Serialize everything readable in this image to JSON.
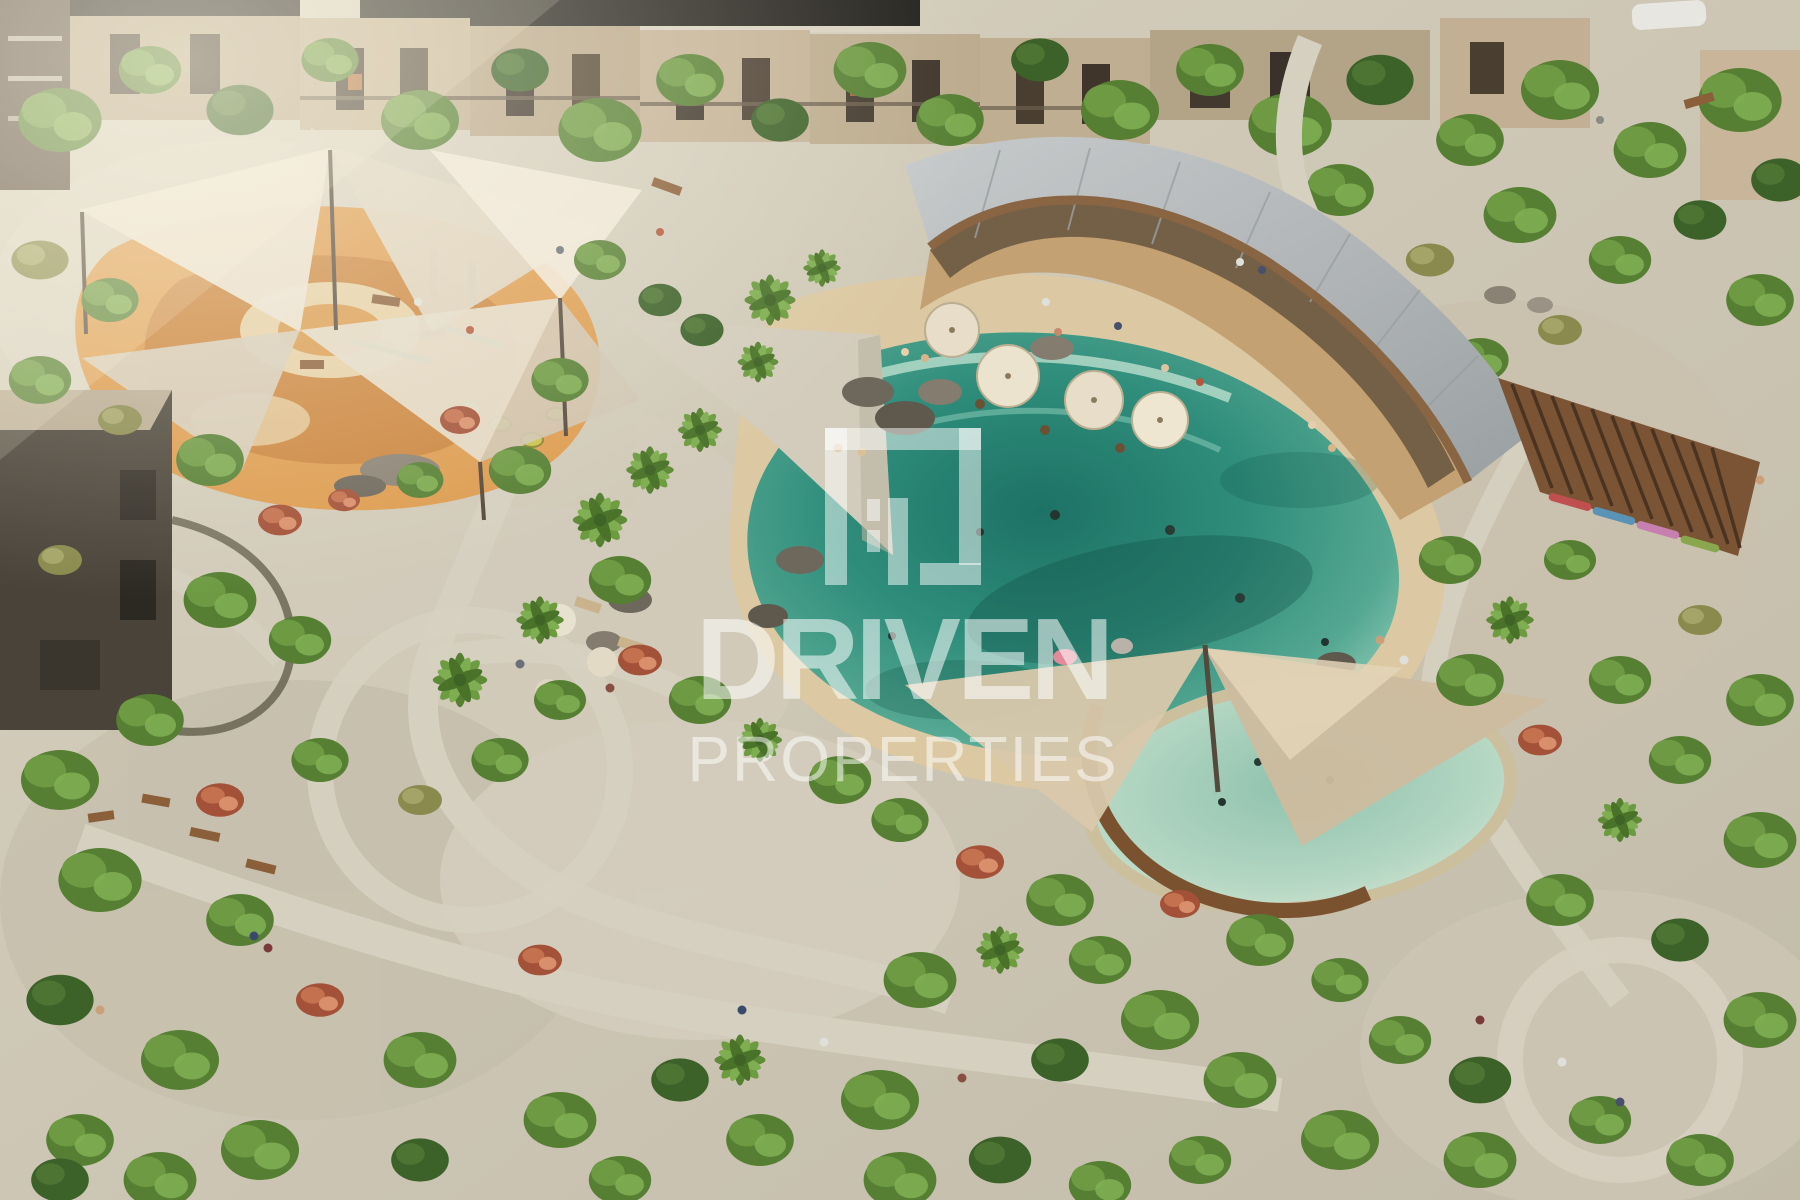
{
  "watermark": {
    "brand": "DRIVEN",
    "subtitle": "PROPERTIES",
    "logo_icon": "driven-properties-logo-icon",
    "color": "#FFFFFF",
    "opacity": "52%"
  },
  "scene": {
    "kind": "aerial-architectural-render",
    "regions": [
      "townhouse-row-top",
      "playground-with-shade-sails",
      "lagoon-pool",
      "beach-entry",
      "curved-clubhouse-roof",
      "restaurant-umbrella-deck",
      "wooden-pergola",
      "kids-pool-with-sails",
      "dark-villa-left",
      "landscaped-paths",
      "dense-greenery-bottom"
    ],
    "colors": {
      "lagoon_deep": "#1d7265",
      "lagoon_mid": "#2f8d7b",
      "lagoon_shallow": "#9ed3c0",
      "sand": "#dcc9a3",
      "path": "#d6d0c1",
      "playground_surface": "#dd9c50",
      "shade_sail": "#e7dfcf",
      "clubhouse_roof": "#b7babb",
      "pergola_wood": "#7a5434",
      "facade_beige": "#c0ae92",
      "foliage_green": "#567f33",
      "foliage_red": "#a35138"
    }
  }
}
